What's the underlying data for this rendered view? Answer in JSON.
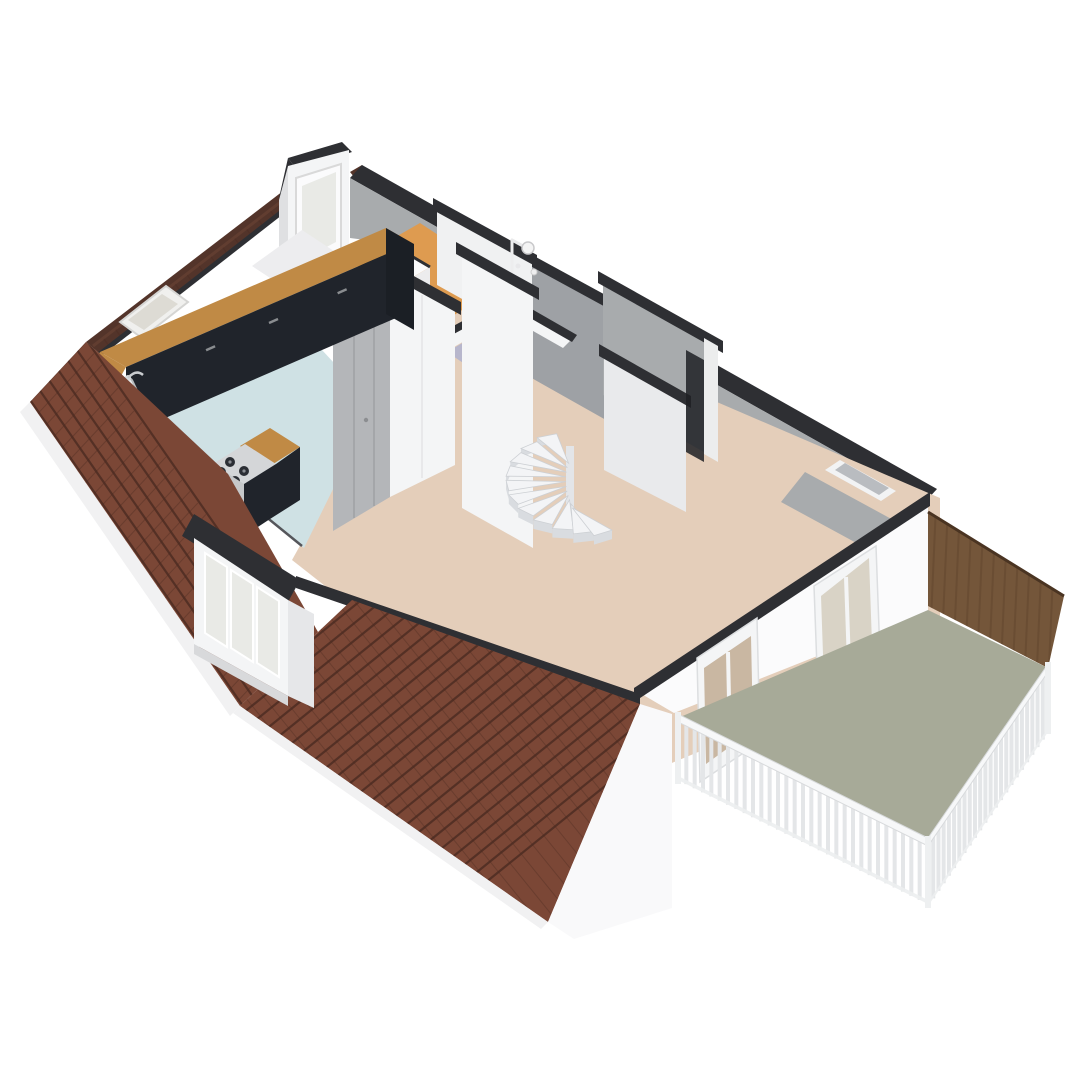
{
  "scene": {
    "description": "3D isometric rendering of an attic floor plan with a spiral staircase, kitchen with counter and cooking island, bathroom with shower, dormer windows, tiled mansard roof and a roof terrace with wood privacy screen and white railing",
    "view": "axonometric-from-above"
  },
  "palette": {
    "bg": "#ffffff",
    "cap": "#2e2f33",
    "roof-base": "#7b4736",
    "roof-line": "#4e2d23",
    "roof-dark": "#53342a",
    "eave": "#f1f1f2",
    "wall-white": "#f4f5f6",
    "wall-bright": "#fbfbfc",
    "wall-gray": "#a8abad",
    "wall-gray-mid": "#b4b6b9",
    "wall-gray-light": "#e9eaec",
    "floor-beige": "#e4ceba",
    "floor-blue": "#cfe1e4",
    "floor-orange": "#de9b50",
    "floor-lavender": "#b7b6cc",
    "floor-sage": "#a7aa98",
    "wood-counter": "#c08a45",
    "wood-dark": "#74563a",
    "wood-grain": "#5c422b",
    "cabinet": "#20242b",
    "stair-top": "#f3f4f6",
    "stair-side": "#d9dce0",
    "glass": "#e9eae6",
    "glass-interior": "#c9b7a2",
    "fixture": "#f4f4f4",
    "railing": "#e4e6e8",
    "rail-top": "#f7f8f9"
  },
  "rooms": [
    {
      "id": "living-area",
      "floor": "beige"
    },
    {
      "id": "kitchen",
      "floor": "light-blue"
    },
    {
      "id": "storage-room",
      "floor": "orange-wood"
    },
    {
      "id": "bathroom",
      "floor": "lavender"
    },
    {
      "id": "hallway",
      "floor": "beige"
    },
    {
      "id": "balcony-terrace",
      "floor": "sage-green"
    }
  ],
  "features": [
    "spiral-staircase",
    "kitchen-counter-with-sink",
    "cooking-island-with-hob",
    "shower-fixture",
    "toilet",
    "dormer-window-large",
    "dormer-window-small",
    "roof-skylight",
    "tiled-mansard-roof",
    "balcony-railing",
    "wood-privacy-screen",
    "balcony-door",
    "facade-window",
    "wall-niche"
  ]
}
